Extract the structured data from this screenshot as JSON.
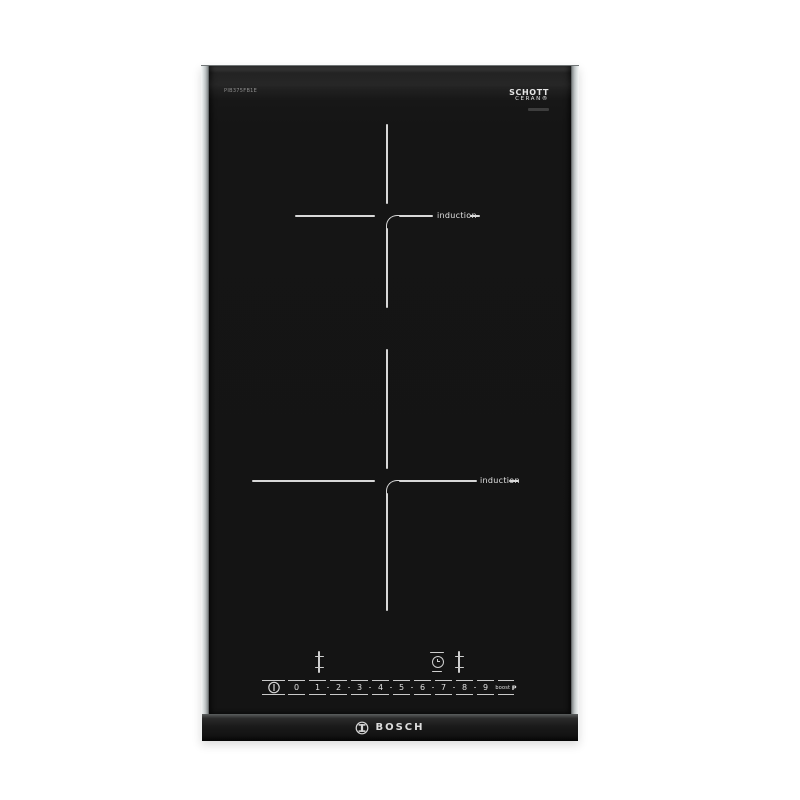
{
  "product": {
    "brand": "BOSCH",
    "model_label": "PIB375FB1E",
    "glass_brand_line1": "SCHOTT",
    "glass_brand_line2": "CERAN®"
  },
  "zones": {
    "zone1_label": "induction",
    "zone2_label": "induction"
  },
  "controls": {
    "levels": [
      "0",
      "1",
      "2",
      "3",
      "4",
      "5",
      "6",
      "7",
      "8",
      "9"
    ],
    "boost_label": "boost",
    "boost_symbol": "P"
  },
  "colors": {
    "glass": "#151515",
    "marking_line": "#d8d8d8",
    "trim_silver": "#c0c5c6",
    "logo_text": "#dddddd"
  }
}
